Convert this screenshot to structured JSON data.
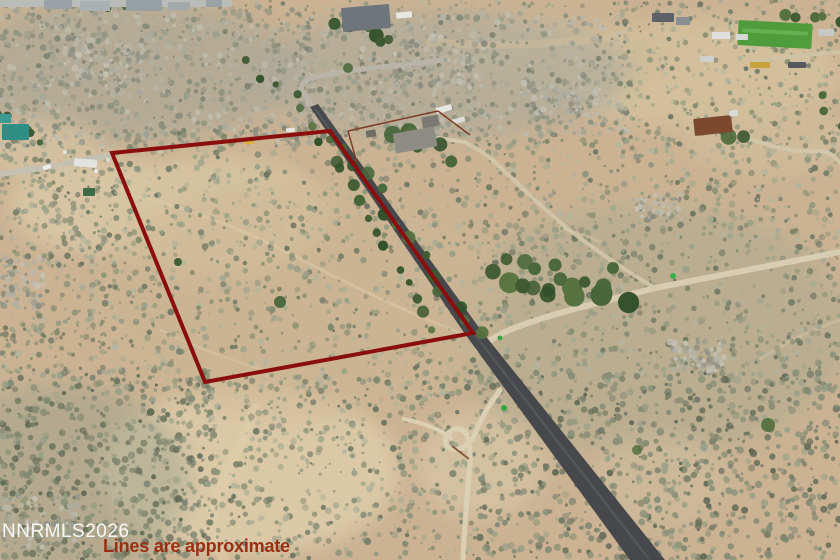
{
  "overlay": {
    "watermark": "NNRMLS2026",
    "disclaimer": "Lines are approximate",
    "watermark_color": "#ffffff",
    "disclaimer_color": "#992f13"
  },
  "scene": {
    "width": 840,
    "height": 560,
    "base_color": "#cab293",
    "boundary": {
      "points": "112,153 330,131 473,333 205,382",
      "color": "#8a0e0e",
      "width": 4
    },
    "palettes": {
      "scrub": [
        "#8c9279",
        "#7a8269",
        "#99a087",
        "#6d7560",
        "#a4a990",
        "#8f947b",
        "#b3b49c"
      ],
      "scrubdark": [
        "#7e8570",
        "#6d745f",
        "#8b9279",
        "#5f6753",
        "#99a087",
        "#848b74"
      ],
      "hill": [
        "#9a9e8e",
        "#8a8e7e",
        "#a8a89a",
        "#7d8170",
        "#b5b2a4",
        "#90947f",
        "#c0bdae"
      ],
      "rock": [
        "#aeaea2",
        "#bcb9ac",
        "#959788",
        "#c6c2b4",
        "#8a8c80"
      ],
      "tree": [
        "#3e5a32",
        "#48663a",
        "#31502a",
        "#567240"
      ]
    },
    "patches": [
      [
        95,
        205,
        85,
        48,
        "#d9c7a6",
        0.9
      ],
      [
        215,
        215,
        115,
        60,
        "#d6c4a2",
        0.9
      ],
      [
        700,
        75,
        140,
        55,
        "#d4c19e",
        0.9
      ],
      [
        560,
        55,
        110,
        35,
        "#cebb99",
        0.8
      ],
      [
        250,
        470,
        150,
        85,
        "#dccaa9",
        0.95
      ],
      [
        480,
        465,
        65,
        55,
        "#d8c6a6",
        0.7
      ],
      [
        130,
        70,
        170,
        70,
        "#a5a697",
        0.55
      ],
      [
        440,
        75,
        190,
        62,
        "#a9a99b",
        0.55
      ],
      [
        650,
        330,
        200,
        125,
        "#aba98e",
        0.45
      ],
      [
        60,
        480,
        130,
        95,
        "#9aa08a",
        0.45
      ],
      [
        300,
        300,
        210,
        120,
        "#cdb795",
        0.5
      ],
      [
        770,
        140,
        90,
        35,
        "#d0bd9b",
        0.7
      ],
      [
        40,
        150,
        60,
        30,
        "#d5c3a2",
        0.8
      ],
      [
        660,
        480,
        70,
        45,
        "#cfbe9e",
        0.6
      ]
    ],
    "trails": [
      {
        "d": "M 130,195 C 200,210 255,235 312,265 C 360,290 420,318 468,336",
        "c": "#ddcba9",
        "w": 3,
        "o": 0.5
      },
      {
        "d": "M 255,408 C 240,450 215,490 212,525 C 211,540 218,552 225,560",
        "c": "#dfcdab",
        "w": 10,
        "o": 0.5
      },
      {
        "d": "M 430,42 C 500,48 570,44 640,33 C 685,26 720,30 748,38",
        "c": "#d2bf9c",
        "w": 8,
        "o": 0.45
      },
      {
        "d": "M 603,243 C 585,235 570,230 556,227",
        "c": "#d8c6a4",
        "w": 3,
        "o": 0.5
      },
      {
        "d": "M 840,320 C 805,332 775,348 756,362",
        "c": "#d8c6a4",
        "w": 3,
        "o": 0.45
      },
      {
        "d": "M 160,330 C 190,345 230,360 270,372",
        "c": "#ddcba9",
        "w": 2.5,
        "o": 0.4
      }
    ],
    "scrub_regions": [
      [
        0,
        6,
        315,
        140,
        900,
        1,
        3.4,
        "hill",
        11
      ],
      [
        295,
        12,
        335,
        125,
        800,
        1,
        3.4,
        "hill",
        22
      ],
      [
        615,
        0,
        225,
        140,
        330,
        1,
        3,
        "scrub",
        33
      ],
      [
        0,
        140,
        118,
        235,
        430,
        1,
        3.4,
        "scrub",
        44
      ],
      [
        0,
        370,
        215,
        190,
        680,
        1.2,
        3.8,
        "scrubdark",
        55
      ],
      [
        112,
        126,
        370,
        262,
        880,
        1,
        3.4,
        "scrub",
        66
      ],
      [
        478,
        138,
        362,
        238,
        980,
        1,
        3.5,
        "scrub",
        77
      ],
      [
        478,
        372,
        362,
        188,
        900,
        1.2,
        3.8,
        "scrubdark",
        88
      ],
      [
        208,
        376,
        278,
        184,
        520,
        1,
        3.5,
        "scrub",
        99
      ],
      [
        0,
        0,
        840,
        10,
        90,
        1,
        2.5,
        "scrub",
        101
      ]
    ],
    "rock_clusters": [
      [
        697,
        357,
        28,
        17,
        90,
        7
      ],
      [
        660,
        207,
        24,
        13,
        60,
        8
      ],
      [
        108,
        62,
        46,
        24,
        120,
        9
      ],
      [
        430,
        62,
        55,
        26,
        130,
        10
      ],
      [
        42,
        522,
        38,
        28,
        90,
        12
      ],
      [
        22,
        282,
        22,
        26,
        70,
        13
      ],
      [
        560,
        100,
        40,
        18,
        70,
        14
      ]
    ],
    "roads": [
      {
        "t": "p",
        "d": "M 0,174 L 42,168 L 112,155",
        "c": "#c6c0b2",
        "w": 6,
        "o": 1
      },
      {
        "t": "p",
        "d": "M 442,60 C 400,66 332,70 307,80 C 299,84 301,91 306,97 L 318,113",
        "c": "#b8b4a7",
        "w": 5,
        "o": 1
      },
      {
        "t": "p",
        "d": "M 840,52 C 812,54 780,58 752,62",
        "c": "#cfc3a6",
        "w": 4,
        "o": 0.9
      },
      {
        "t": "p",
        "d": "M 840,252 L 655,288 C 610,300 540,316 505,332 C 492,339 483,344 478,349",
        "c": "#d8cdb2",
        "w": 6,
        "o": 1
      },
      {
        "t": "p",
        "d": "M 655,288 C 618,266 590,246 568,229 C 546,211 520,186 499,166 C 487,154 473,146 464,142",
        "c": "#d4c8ad",
        "w": 4,
        "o": 0.85
      },
      {
        "t": "p",
        "d": "M 438,138 C 450,140 458,141 464,142",
        "c": "#d4c8ad",
        "w": 4,
        "o": 1
      },
      {
        "t": "p",
        "d": "M 500,390 C 490,404 482,416 477,429 C 471,445 459,453 450,448 C 442,443 445,431 456,429 C 468,427 471,442 470,463 C 467,496 464,530 463,560",
        "c": "#dcd0b4",
        "w": 5,
        "o": 1
      },
      {
        "t": "p",
        "d": "M 404,419 C 424,423 441,430 451,438",
        "c": "#dcd0b4",
        "w": 4,
        "o": 1
      },
      {
        "t": "p",
        "d": "M 734,134 C 762,143 790,153 812,151 C 827,149 835,156 840,163",
        "c": "#d2c6aa",
        "w": 4,
        "o": 1
      },
      {
        "t": "p",
        "d": "M 58,165 C 68,173 76,181 81,190",
        "c": "#cfc4aa",
        "w": 4,
        "o": 0.75
      },
      {
        "t": "g",
        "pts": "310,107 318,104 480,329 665,560 630,560 465,334",
        "c": "#46484b"
      },
      {
        "t": "p",
        "d": "M 316,110 L 472,331 L 648,558",
        "c": "#5a5c5f",
        "w": 2.5,
        "o": 0.7
      }
    ],
    "tree_lines": [
      [
        313,
        127,
        436,
        328,
        14,
        6,
        3,
        6.5,
        201
      ],
      [
        335,
        133,
        477,
        331,
        14,
        7,
        3,
        7,
        202
      ],
      [
        488,
        276,
        620,
        296,
        11,
        9,
        6,
        11,
        203
      ],
      [
        505,
        260,
        598,
        282,
        7,
        8,
        5,
        8,
        204
      ],
      [
        338,
        17,
        396,
        42,
        6,
        8,
        4,
        8,
        205
      ],
      [
        390,
        128,
        448,
        158,
        6,
        8,
        5,
        9,
        206
      ],
      [
        706,
        124,
        744,
        140,
        4,
        5,
        5,
        8,
        207
      ],
      [
        788,
        12,
        836,
        26,
        5,
        6,
        4,
        7,
        208
      ],
      [
        2,
        110,
        42,
        146,
        5,
        6,
        3,
        6,
        209
      ],
      [
        818,
        98,
        838,
        128,
        3,
        5,
        4,
        6,
        210
      ],
      [
        250,
        62,
        292,
        96,
        4,
        7,
        3,
        5,
        211
      ],
      [
        95,
        2,
        128,
        8,
        3,
        5,
        3,
        5,
        212
      ]
    ],
    "trees": [
      [
        768,
        425,
        7
      ],
      [
        613,
        268,
        6
      ],
      [
        280,
        302,
        6
      ],
      [
        178,
        262,
        4
      ],
      [
        637,
        450,
        5
      ],
      [
        348,
        68,
        5
      ],
      [
        300,
        108,
        4
      ]
    ],
    "buildings": [
      [
        0,
        0,
        232,
        7,
        0,
        "#b9bcb8"
      ],
      [
        44,
        0,
        28,
        9,
        0,
        "#9aa2a8"
      ],
      [
        80,
        1,
        30,
        10,
        0,
        "#aab1b5"
      ],
      [
        126,
        0,
        36,
        11,
        0,
        "#97a0a4"
      ],
      [
        168,
        2,
        22,
        8,
        0,
        "#a3aaae"
      ],
      [
        206,
        0,
        16,
        7,
        0,
        "#9aa2a6"
      ],
      [
        342,
        6,
        48,
        24,
        -5,
        "#6e757b"
      ],
      [
        396,
        12,
        16,
        6,
        -5,
        "#e8e7e2"
      ],
      [
        738,
        22,
        74,
        25,
        3,
        "#4f9c3c"
      ],
      [
        742,
        30,
        66,
        4,
        3,
        "#66b053"
      ],
      [
        652,
        13,
        22,
        9,
        0,
        "#5d6268"
      ],
      [
        676,
        17,
        14,
        8,
        0,
        "#8a8f93"
      ],
      [
        712,
        32,
        18,
        7,
        0,
        "#dfe0dc"
      ],
      [
        736,
        34,
        12,
        6,
        0,
        "#d7d8d4"
      ],
      [
        818,
        29,
        16,
        7,
        0,
        "#c8c9c5"
      ],
      [
        750,
        62,
        20,
        6,
        0,
        "#c9a33a"
      ],
      [
        788,
        62,
        18,
        6,
        0,
        "#55585c"
      ],
      [
        700,
        56,
        14,
        6,
        0,
        "#cfd0cc"
      ],
      [
        2,
        124,
        27,
        16,
        0,
        "#2f8e86"
      ],
      [
        0,
        114,
        11,
        9,
        0,
        "#3b9b90"
      ],
      [
        394,
        130,
        42,
        20,
        -10,
        "#8e8d85"
      ],
      [
        422,
        116,
        17,
        11,
        -10,
        "#7b7a72"
      ],
      [
        436,
        106,
        16,
        6,
        -15,
        "#e6e6e2"
      ],
      [
        452,
        118,
        13,
        5,
        -15,
        "#dcdcd8"
      ],
      [
        366,
        130,
        10,
        7,
        -10,
        "#6f6e66"
      ],
      [
        694,
        117,
        38,
        17,
        -6,
        "#7c482e"
      ],
      [
        729,
        110,
        9,
        6,
        -6,
        "#d8d8d4"
      ],
      [
        74,
        159,
        23,
        8,
        4,
        "#e2e2de"
      ],
      [
        83,
        188,
        12,
        8,
        0,
        "#3c6b46"
      ],
      [
        244,
        139,
        10,
        5,
        -3,
        "#d8b13a"
      ],
      [
        286,
        128,
        9,
        4,
        -3,
        "#e4e4e0"
      ],
      [
        43,
        165,
        8,
        4,
        -20,
        "#eeeeea"
      ]
    ],
    "objects": [
      [
        673,
        276,
        3,
        "#3dae49"
      ],
      [
        504,
        408,
        3,
        "#36a344"
      ],
      [
        500,
        338,
        2.5,
        "#36a344"
      ],
      [
        96,
        171,
        2,
        "#e8e8e4"
      ],
      [
        108,
        160,
        2,
        "#dcdcd8"
      ],
      [
        65,
        152,
        2,
        "#e0e0dc"
      ],
      [
        120,
        175,
        2,
        "#b0aca0"
      ],
      [
        160,
        152,
        2,
        "#c8c4b8"
      ]
    ],
    "fences": [
      {
        "d": "M 348,131 L 438,111",
        "c": "#7c3d26",
        "w": 1.5
      },
      {
        "d": "M 348,131 L 357,163",
        "c": "#7c3d26",
        "w": 1.5
      },
      {
        "d": "M 438,111 L 470,135",
        "c": "#7c3d26",
        "w": 1.5
      },
      {
        "d": "M 452,446 L 469,459",
        "c": "#8a5a3a",
        "w": 2
      }
    ]
  }
}
